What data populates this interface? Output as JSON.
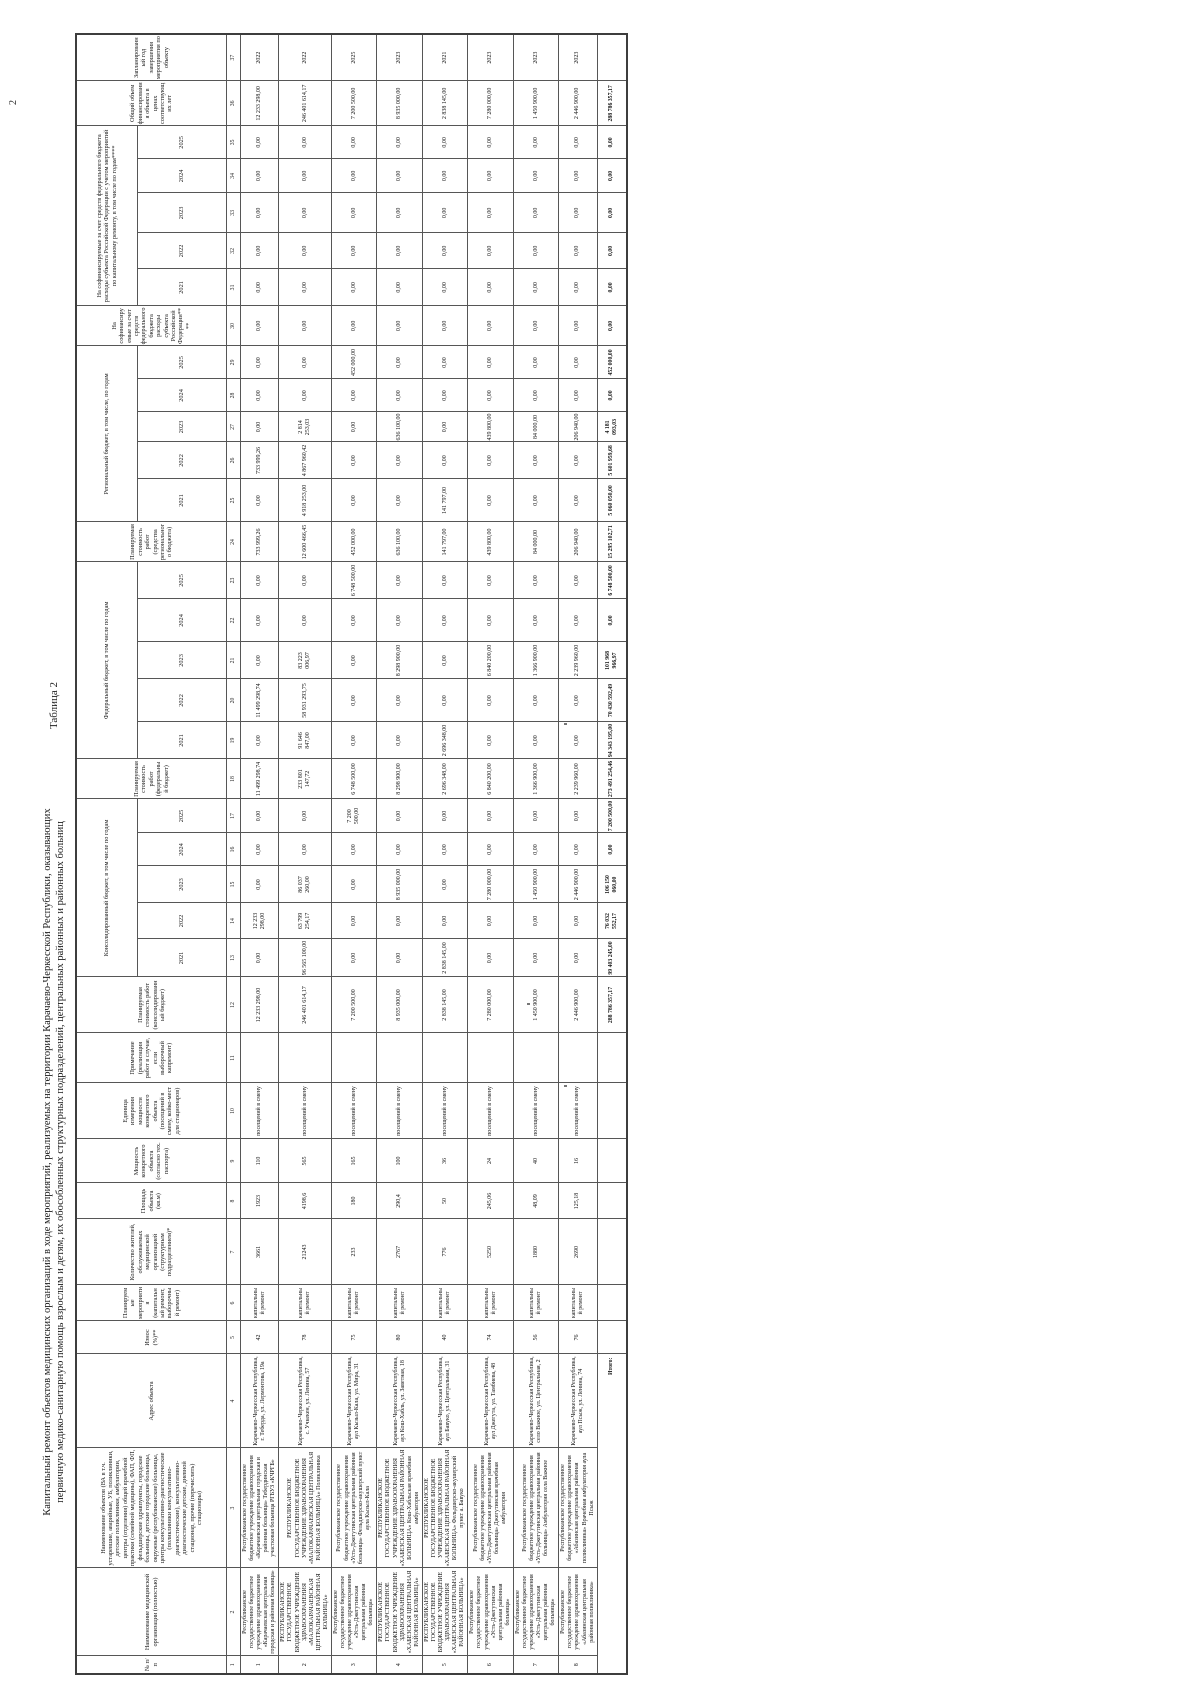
{
  "page": {
    "caption": "Таблица 2",
    "page_number": "2",
    "title_line1": "Капитальный ремонт объектов медицинских организаций в ходе мероприятий, реализуемых на территории Карачаево-Черкесской Республики, оказывающих",
    "title_line2": "первичную медико-санитарную помощь взрослым и детям, их обособленных структурных подразделений, центральных районных и районных больниц"
  },
  "table": {
    "col_widths": [
      18,
      88,
      120,
      94,
      33,
      36,
      66,
      36,
      44,
      56,
      50,
      56,
      38,
      36,
      37,
      33,
      34,
      40,
      37,
      43,
      37,
      43,
      37,
      40,
      43,
      37,
      30,
      33,
      33,
      40,
      37,
      36,
      40,
      34,
      33,
      45,
      47
    ],
    "header_row1": [
      {
        "text": "№ п/п",
        "colspan": 1,
        "rowspan": 2
      },
      {
        "text": "Наименование медицинской организации (полностью)",
        "colspan": 1,
        "rowspan": 2
      },
      {
        "text": "Наименование объектов (ВА в т.ч. устаревшие, аварийные, УБ, поликлиники, детские поликлиники, амбулатории, центры (отделения) общей врачебной практики (семейной медицины), ФАП, ФП, фельдшерские здравпункты, городские больницы, детские городские больницы, окружные (республиканские) больницы, центры консультативно-диагностические (поликлиники консультативно-диагностические), консультативно-диагностические детские, дневной стационар, прочие (перечислить) стационары)",
        "colspan": 1,
        "rowspan": 2
      },
      {
        "text": "Адрес объекта",
        "colspan": 1,
        "rowspan": 2
      },
      {
        "text": "Износ (%)**",
        "colspan": 1,
        "rowspan": 2
      },
      {
        "text": "Планируемые мероприятия (капитальный ремонт, выборочный ремонт)",
        "colspan": 1,
        "rowspan": 2
      },
      {
        "text": "Количество жителей, обслуживаемых медицинской организацией (структурным подразделением)*",
        "colspan": 1,
        "rowspan": 2
      },
      {
        "text": "Площадь объекта (кв.м)",
        "colspan": 1,
        "rowspan": 2
      },
      {
        "text": "Мощность конкретного объекта (согласно тех. паспорта)",
        "colspan": 1,
        "rowspan": 2
      },
      {
        "text": "Единица измерения мощности конкретного объекта (посещений в смену, койко-мест для стационаров)",
        "colspan": 1,
        "rowspan": 2
      },
      {
        "text": "Примечание (реализация работ в случае, если выборочный капремонт)",
        "colspan": 1,
        "rowspan": 2
      },
      {
        "text": "Планируемая стоимость работ (консолидированный бюджет)",
        "colspan": 1,
        "rowspan": 2
      },
      {
        "text": "Консолидированный бюджет, в том числе по годам",
        "colspan": 5,
        "rowspan": 1
      },
      {
        "text": "Планируемая стоимость работ (федеральный бюджет)",
        "colspan": 1,
        "rowspan": 2
      },
      {
        "text": "Федеральный бюджет, в том числе по годам",
        "colspan": 5,
        "rowspan": 1
      },
      {
        "text": "Планируемая стоимость работ (средства регионального бюджета)",
        "colspan": 1,
        "rowspan": 2
      },
      {
        "text": "Региональный бюджет, в том числе, по годам",
        "colspan": 5,
        "rowspan": 1
      },
      {
        "text": "На софинансируемые за счет средств федерального бюджета расходы субъекта Российской Федерации****",
        "colspan": 1,
        "rowspan": 2
      },
      {
        "text": "На софинансируемые за счет средств федерального бюджета расходы субъекта Российской Федерации с учетом мероприятий по капитальному ремонту, в том числе по годам****",
        "colspan": 5,
        "rowspan": 1
      },
      {
        "text": "Общий объем финансирования объекта в ценах соответствующих лет",
        "colspan": 1,
        "rowspan": 2
      },
      {
        "text": "Запланированный год завершения мероприятия по объекту",
        "colspan": 1,
        "rowspan": 2
      }
    ],
    "years": [
      "2021",
      "2022",
      "2023",
      "2024",
      "2025"
    ],
    "year_group_count": 4,
    "col_numbers": [
      "1",
      "2",
      "3",
      "4",
      "5",
      "6",
      "7",
      "8",
      "9",
      "10",
      "11",
      "12",
      "13",
      "14",
      "15",
      "16",
      "17",
      "18",
      "19",
      "20",
      "21",
      "22",
      "23",
      "24",
      "25",
      "26",
      "27",
      "28",
      "29",
      "30",
      "31",
      "32",
      "33",
      "34",
      "35",
      "36",
      "37"
    ],
    "records": [
      {
        "cells": [
          "1",
          "Республиканское государственное бюджетное учреждение здравоохранения «Карачаевская центральная городская и районная больница»",
          "Республиканское государственное бюджетное учреждение здравоохранения «Карачаевская центральная городская и районная больница» Тебердинская участковая больница РГБУЗ «КЧРГБ»",
          "Карачаево-Черкесская Республика, г. Теберда, ул. Лермонтова, 19а",
          "42",
          "капитальный ремонт",
          "3661",
          "1923",
          "110",
          "посещений в смену",
          "",
          "12 233 298,00",
          "0,00",
          "12 233 298,00",
          "0,00",
          "0,00",
          "0,00",
          "11 499 298,74",
          "0,00",
          "11 499 298,74",
          "0,00",
          "0,00",
          "0,00",
          "733 999,26",
          "0,00",
          "733 999,26",
          "0,00",
          "0,00",
          "0,00",
          "0,00",
          "0,00",
          "0,00",
          "0,00",
          "0,00",
          "0,00",
          "12 233 298,00",
          "2022"
        ]
      },
      {
        "cells": [
          "2",
          "РЕСПУБЛИКАНСКОЕ ГОСУДАРСТВЕННОЕ БЮДЖЕТНОЕ УЧРЕЖДЕНИЕ ЗДРАВООХРАНЕНИЯ «МАЛОКАРАЧАЕВСКАЯ ЦЕНТРАЛЬНАЯ РАЙОННАЯ БОЛЬНИЦА»",
          "РЕСПУБЛИКАНСКОЕ ГОСУДАРСТВЕННОЕ БЮДЖЕТНОЕ УЧРЕЖДЕНИЕ ЗДРАВООХРАНЕНИЯ «МАЛОКАРАЧАЕВСКАЯ ЦЕНТРАЛЬНАЯ РАЙОННАЯ БОЛЬНИЦА» Поликлиника",
          "Карачаево-Черкесская Республика, с. Учкекен, ул. Ленина, 57",
          "78",
          "капитальный ремонт",
          "21243",
          "4198,6",
          "565",
          "посещений в смену",
          "",
          "246 401 614,17",
          "96 565 100,00",
          "63 799 254,17",
          "86 037 260,00",
          "0,00",
          "0,00",
          "233 801 147,72",
          "91 646 847,00",
          "58 931 293,75",
          "83 223 006,97",
          "0,00",
          "0,00",
          "12 600 466,45",
          "4 918 253,00",
          "4 867 960,42",
          "2 814 253,03",
          "0,00",
          "0,00",
          "0,00",
          "0,00",
          "0,00",
          "0,00",
          "0,00",
          "0,00",
          "246 401 614,17",
          "2022"
        ]
      },
      {
        "cells": [
          "3",
          "Республиканское государственное бюджетное учреждение здравоохранения «Усть-Джегутинская центральная районная больница»",
          "Республиканское государственное бюджетное учреждение здравоохранения «Усть-Джегутинская центральная районная больница» Фельдшерско-акушерский пункт аула Кызыл-Кала",
          "Карачаево-Черкесская Республика, аул Кызыл-Кала, ул. Мира, 31",
          "75",
          "капитальный ремонт",
          "233",
          "180",
          "165",
          "посещений в смену",
          "",
          "7 200 500,00",
          "0,00",
          "0,00",
          "0,00",
          "0,00",
          "7 200 500,00",
          "6 748 500,00",
          "0,00",
          "0,00",
          "0,00",
          "0,00",
          "6 748 500,00",
          "452 000,00",
          "0,00",
          "0,00",
          "0,00",
          "0,00",
          "452 000,00",
          "0,00",
          "0,00",
          "0,00",
          "0,00",
          "0,00",
          "0,00",
          "7 200 500,00",
          "2025"
        ]
      },
      {
        "cells": [
          "4",
          "РЕСПУБЛИКАНСКОЕ ГОСУДАРСТВЕННОЕ БЮДЖЕТНОЕ УЧРЕЖДЕНИЕ ЗДРАВООХРАНЕНИЯ «ХАБЕЗСКАЯ ЦЕНТРАЛЬНАЯ РАЙОННАЯ БОЛЬНИЦА»",
          "РЕСПУБЛИКАНСКОЕ ГОСУДАРСТВЕННОЕ БЮДЖЕТНОЕ УЧРЕЖДЕНИЕ ЗДРАВООХРАНЕНИЯ «ХАБЕЗСКАЯ ЦЕНТРАЛЬНАЯ РАЙОННАЯ БОЛЬНИЦА» Кош-Хабльская врачебная амбулатория",
          "Карачаево-Черкесская Республика, аул Кош-Хабль, ул. Заветная, 18",
          "80",
          "капитальный ремонт",
          "2767",
          "290,4",
          "100",
          "посещений в смену",
          "",
          "8 935 000,00",
          "0,00",
          "0,00",
          "8 935 000,00",
          "0,00",
          "0,00",
          "8 298 900,00",
          "0,00",
          "0,00",
          "8 298 900,00",
          "0,00",
          "0,00",
          "636 100,00",
          "0,00",
          "0,00",
          "636 100,00",
          "0,00",
          "0,00",
          "0,00",
          "0,00",
          "0,00",
          "0,00",
          "0,00",
          "0,00",
          "8 935 000,00",
          "2023"
        ]
      },
      {
        "cells": [
          "5",
          "РЕСПУБЛИКАНСКОЕ ГОСУДАРСТВЕННОЕ БЮДЖЕТНОЕ УЧРЕЖДЕНИЕ ЗДРАВООХРАНЕНИЯ «ХАБЕЗСКАЯ ЦЕНТРАЛЬНАЯ РАЙОННАЯ БОЛЬНИЦА»",
          "РЕСПУБЛИКАНСКОЕ ГОСУДАРСТВЕННОЕ БЮДЖЕТНОЕ УЧРЕЖДЕНИЕ ЗДРАВООХРАНЕНИЯ «ХАБЕЗСКАЯ ЦЕНТРАЛЬНАЯ РАЙОННАЯ БОЛЬНИЦА» Фельдшерско-акушерский пункт а. Бавуко",
          "Карачаево-Черкесская Республика, аул Бавуко, ул. Центральная, 31",
          "40",
          "капитальный ремонт",
          "776",
          "50",
          "36",
          "посещений в смену",
          "",
          "2 838 145,00",
          "2 838 145,00",
          "0,00",
          "0,00",
          "0,00",
          "0,00",
          "2 696 348,00",
          "2 696 348,00",
          "0,00",
          "0,00",
          "0,00",
          "0,00",
          "141 797,00",
          "141 797,00",
          "0,00",
          "0,00",
          "0,00",
          "0,00",
          "0,00",
          "0,00",
          "0,00",
          "0,00",
          "0,00",
          "0,00",
          "2 838 145,00",
          "2021"
        ]
      },
      {
        "cells": [
          "6",
          "Республиканское государственное бюджетное учреждение здравоохранения «Усть-Джегутинская центральная районная больница»",
          "Республиканское государственное бюджетное учреждение здравоохранения «Усть-Джегутинская центральная районная больница» Джегутинская врачебная амбулатория",
          "Карачаево-Черкесская Республика, аул Джегута, ул. Тамбиева, 48",
          "74",
          "капитальный ремонт",
          "5250",
          "245,06",
          "24",
          "посещений в смену",
          "",
          "7 280 000,00",
          "0,00",
          "0,00",
          "7 280 000,00",
          "0,00",
          "0,00",
          "6 840 200,00",
          "0,00",
          "0,00",
          "6 840 200,00",
          "0,00",
          "0,00",
          "439 800,00",
          "0,00",
          "0,00",
          "439 800,00",
          "0,00",
          "0,00",
          "0,00",
          "0,00",
          "0,00",
          "0,00",
          "0,00",
          "0,00",
          "7 280 000,00",
          "2023"
        ]
      },
      {
        "cells": [
          "7",
          "Республиканское государственное бюджетное учреждение здравоохранения «Усть-Джегутинская центральная районная больница»",
          "Республиканское государственное бюджетное учреждение здравоохранения «Усть-Джегутинская центральная районная больница» Амбулатория села Важное",
          "Карачаево-Черкесская Республика, село Важное, ул. Центральная, 2",
          "56",
          "капитальный ремонт",
          "1880",
          "48,09",
          "40",
          "посещений в смену",
          "",
          "1 450 900,00",
          "0,00",
          "0,00",
          "1 450 900,00",
          "0,00",
          "0,00",
          "1 366 900,00",
          "0,00",
          "0,00",
          "1 366 900,00",
          "0,00",
          "0,00",
          "84 000,00",
          "0,00",
          "0,00",
          "84 000,00",
          "0,00",
          "0,00",
          "0,00",
          "0,00",
          "0,00",
          "0,00",
          "0,00",
          "0,00",
          "1 450 900,00",
          "2023"
        ]
      },
      {
        "cells": [
          "8",
          "Республиканское государственное бюджетное учреждение здравоохранения «Абазинская центральная районная поликлиника»",
          "Республиканское государственное бюджетное учреждение здравоохранения «Абазинская центральная районная поликлиника» Врачебная амбулатория аула Псыж",
          "Карачаево-Черкесская Республика, аул Псыж, ул. Ленина, 74",
          "76",
          "капитальный ремонт",
          "2690",
          "125,18",
          "16",
          "посещений в смену",
          "",
          "2 446 900,00",
          "0,00",
          "0,00",
          "2 446 900,00",
          "0,00",
          "0,00",
          "2 239 960,00",
          "0,00",
          "0,00",
          "2 239 960,00",
          "0,00",
          "0,00",
          "206 940,00",
          "0,00",
          "0,00",
          "206 940,00",
          "0,00",
          "0,00",
          "0,00",
          "0,00",
          "0,00",
          "0,00",
          "0,00",
          "0,00",
          "2 446 900,00",
          "2023"
        ]
      }
    ],
    "total": {
      "label": "Итого:",
      "cells": [
        "",
        "",
        "",
        "",
        "",
        "",
        "",
        "288 786 357,17",
        "99 403 245,00",
        "76 032 552,17",
        "106 150 060,00",
        "0,00",
        "7 200 500,00",
        "273 491 254,46",
        "94 343 195,00",
        "70 430 592,49",
        "101 968 966,97",
        "0,00",
        "6 748 500,00",
        "15 295 102,71",
        "5 060 050,00",
        "5 601 959,68",
        "4 181 093,03",
        "0,00",
        "452 000,00",
        "0,00",
        "0,00",
        "0,00",
        "0,00",
        "0,00",
        "0,00",
        "288 786 357,17",
        ""
      ]
    }
  },
  "artifacts": {
    "specks": [
      {
        "x": 564,
        "y": 723
      },
      {
        "x": 564,
        "y": 1085
      },
      {
        "x": 527,
        "y": 1003
      }
    ]
  }
}
